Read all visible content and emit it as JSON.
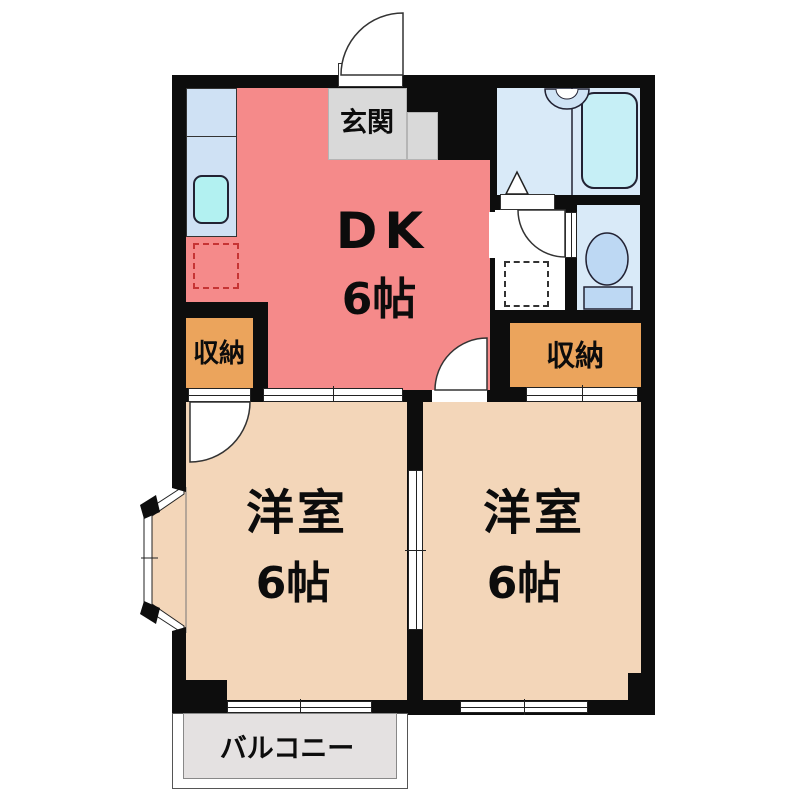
{
  "floorplan": {
    "rooms": {
      "dk": {
        "label": "DK",
        "size": "6帖"
      },
      "entrance": {
        "label": "玄関"
      },
      "closet_left": {
        "label": "収納"
      },
      "closet_right": {
        "label": "収納"
      },
      "western_left": {
        "label": "洋室",
        "size": "6帖"
      },
      "western_right": {
        "label": "洋室",
        "size": "6帖"
      },
      "balcony": {
        "label": "バルコニー"
      }
    },
    "fixtures": [
      "kitchen-sink",
      "refrigerator-space",
      "bathtub",
      "washbasin",
      "shower-folding-door",
      "washing-machine-space",
      "toilet",
      "entry-door",
      "bay-window",
      "sliding-doors",
      "hinged-doors"
    ],
    "colors": {
      "wall": "#0d0d0d",
      "dk": "#f58a8a",
      "western_room": "#f3d6b9",
      "closet": "#eba45c",
      "sanitary": "#d9eaf8",
      "bathtub": "#c6eff6",
      "kitchen_counter": "#cfe1f4",
      "sink": "#b2f1f1",
      "entrance": "#d9d9d9",
      "balcony": "#e4e1e1"
    }
  }
}
